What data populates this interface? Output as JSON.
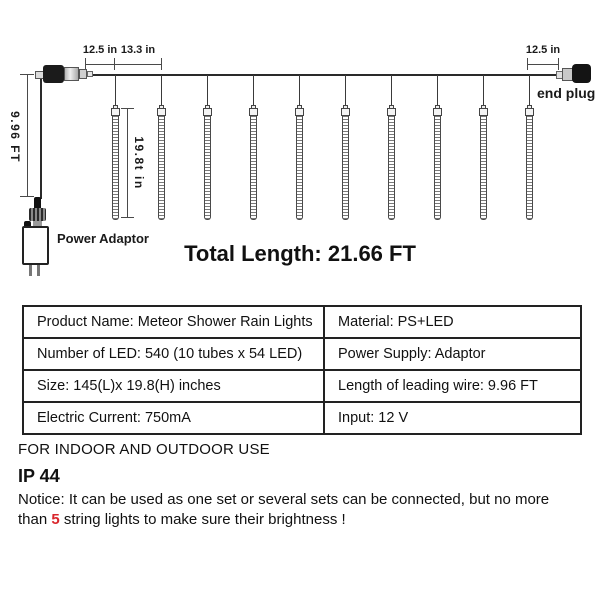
{
  "diagram": {
    "dim_spacing_1": "12.5 in",
    "dim_spacing_2": "13.3 in",
    "dim_spacing_right": "12.5 in",
    "dim_leading_wire": "9.96 FT",
    "dim_tube_height": "19.8t in",
    "end_plug_label": "end plug",
    "power_adaptor_label": "Power Adaptor",
    "total_length": "Total Length: 21.66 FT"
  },
  "table": {
    "rows": [
      {
        "left": "Product Name: Meteor Shower Rain Lights",
        "right": "Material: PS+LED"
      },
      {
        "left": "Number of LED: 540 (10 tubes x 54 LED)",
        "right": "Power Supply: Adaptor"
      },
      {
        "left": "Size: 145(L)x 19.8(H) inches",
        "right": "Length of leading wire: 9.96 FT"
      },
      {
        "left": "Electric Current: 750mA",
        "right": "Input: 12 V"
      }
    ]
  },
  "footer": {
    "usage": "FOR INDOOR AND OUTDOOR USE",
    "ip_rating": "IP 44",
    "notice_line1": "Notice: It can be used as one set or several sets can be connected, but no more",
    "notice_line2_before": "than ",
    "notice_highlight": "5",
    "notice_line2_after": " string lights to make sure their brightness !"
  },
  "colors": {
    "highlight_red": "#d9252b",
    "line_dark": "#2a2a2a",
    "background": "#ffffff"
  }
}
